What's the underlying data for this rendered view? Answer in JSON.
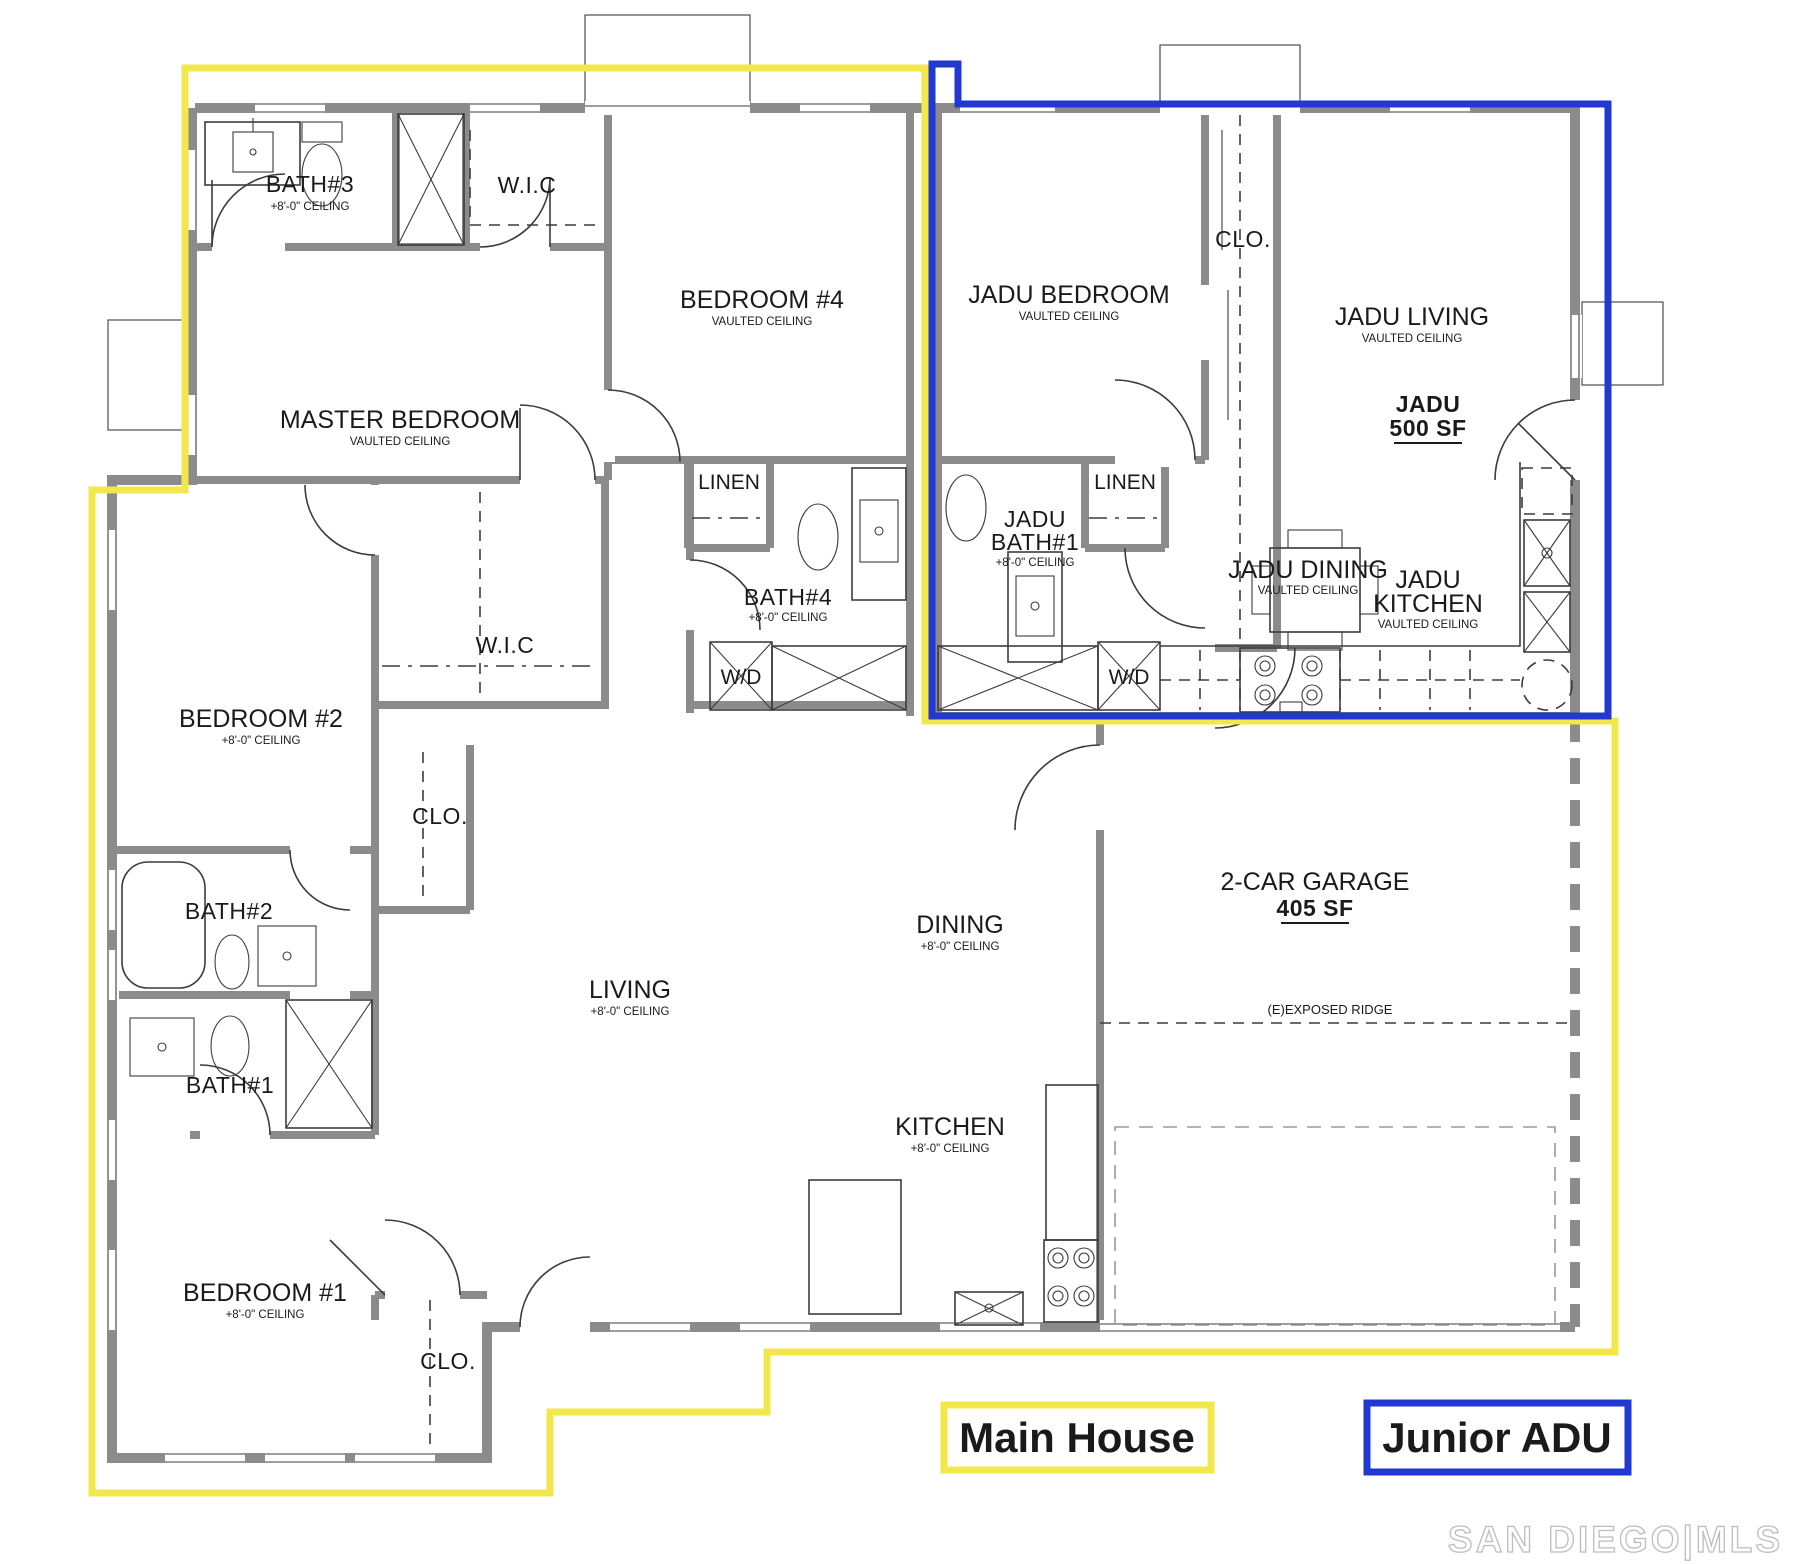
{
  "rooms": {
    "bath3": {
      "label": "BATH#3",
      "sub": "+8'-0\" CEILING"
    },
    "wic_top": {
      "label": "W.I.C"
    },
    "bedroom4": {
      "label": "BEDROOM #4",
      "sub": "VAULTED CEILING"
    },
    "master": {
      "label": "MASTER BEDROOM",
      "sub": "VAULTED CEILING"
    },
    "jadu_bedroom": {
      "label": "JADU BEDROOM",
      "sub": "VAULTED CEILING"
    },
    "jadu_clo": {
      "label": "CLO."
    },
    "jadu_living": {
      "label": "JADU LIVING",
      "sub": "VAULTED CEILING"
    },
    "jadu_area": {
      "label": "JADU",
      "value": "500 SF"
    },
    "linen_left": {
      "label": "LINEN"
    },
    "linen_right": {
      "label": "LINEN"
    },
    "jadu_bath1": {
      "label": "JADU",
      "label2": "BATH#1",
      "sub": "+8'-0\" CEILING"
    },
    "bath4": {
      "label": "BATH#4",
      "sub": "+8'-0\" CEILING"
    },
    "jadu_dining": {
      "label": "JADU DINING",
      "sub": "VAULTED CEILING"
    },
    "jadu_kitchen": {
      "label": "JADU",
      "label2": "KITCHEN",
      "sub": "VAULTED CEILING"
    },
    "wd_left": {
      "label": "W/D"
    },
    "wd_right": {
      "label": "W/D"
    },
    "bedroom2": {
      "label": "BEDROOM #2",
      "sub": "+8'-0\" CEILING"
    },
    "wic2": {
      "label": "W.I.C"
    },
    "clo2": {
      "label": "CLO."
    },
    "bath2": {
      "label": "BATH#2"
    },
    "dining": {
      "label": "DINING",
      "sub": "+8'-0\" CEILING"
    },
    "garage": {
      "label": "2-CAR GARAGE",
      "value": "405 SF"
    },
    "ridge": {
      "label": "(E)EXPOSED RIDGE"
    },
    "bath1": {
      "label": "BATH#1"
    },
    "living": {
      "label": "LIVING",
      "sub": "+8'-0\" CEILING"
    },
    "kitchen": {
      "label": "KITCHEN",
      "sub": "+8'-0\" CEILING"
    },
    "bedroom1": {
      "label": "BEDROOM #1",
      "sub": "+8'-0\" CEILING"
    },
    "clo1": {
      "label": "CLO."
    }
  },
  "legend": {
    "main_house": "Main House",
    "junior_adu": "Junior ADU"
  },
  "watermark": {
    "text": "SAN DIEGO|MLS"
  },
  "colors": {
    "main_house_outline": "#f2e74b",
    "junior_adu_outline": "#2239d1",
    "walls": "#8b8b8b",
    "text": "#1a1a1a",
    "watermark": "#bdbdbd"
  }
}
